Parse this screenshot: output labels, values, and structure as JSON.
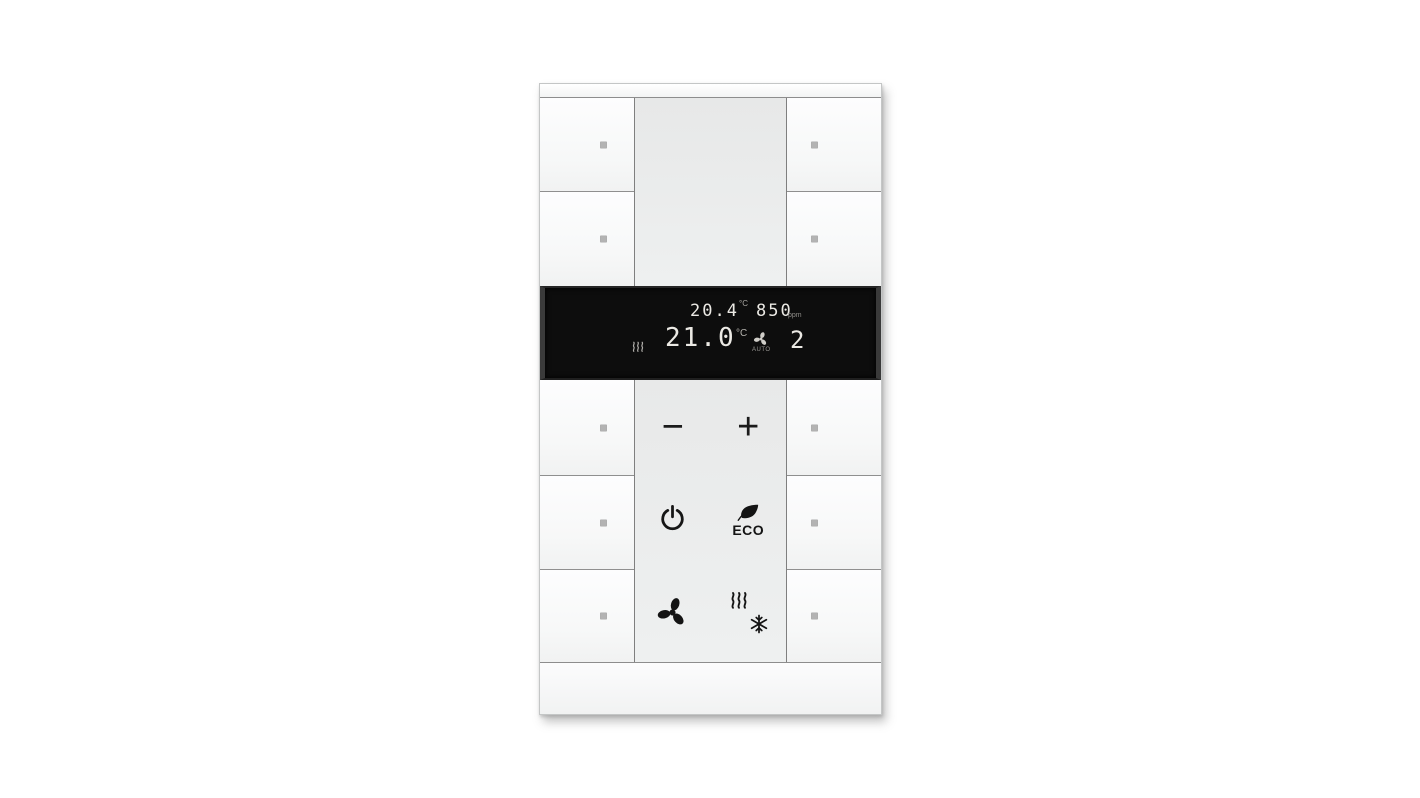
{
  "device": {
    "type": "room-temperature-controller",
    "colors": {
      "display_background": "#0d0d0d",
      "display_digits": "#ebe9e4",
      "display_dim_text": "#9a9894",
      "panel_gray": "#e9eaea",
      "button_white": "#fbfbfc",
      "divider_line": "#8a8a8a",
      "led_dot": "#b3b3b3",
      "icon_black": "#1a1a1a"
    }
  },
  "display": {
    "ambient_temperature": "20.4",
    "ambient_temperature_unit": "°C",
    "air_quality_value": "850",
    "air_quality_unit": "ppm",
    "setpoint_temperature": "21.0",
    "setpoint_temperature_unit": "°C",
    "fan_mode": "AUTO",
    "fan_level": "2",
    "status_icons": [
      "heat-waves-icon",
      "fan-auto-icon"
    ]
  },
  "controls": {
    "minus": "−",
    "plus": "+",
    "eco_label": "ECO",
    "icons": [
      "power-icon",
      "leaf-icon",
      "fan-icon",
      "heat-waves-icon",
      "snowflake-icon"
    ]
  }
}
